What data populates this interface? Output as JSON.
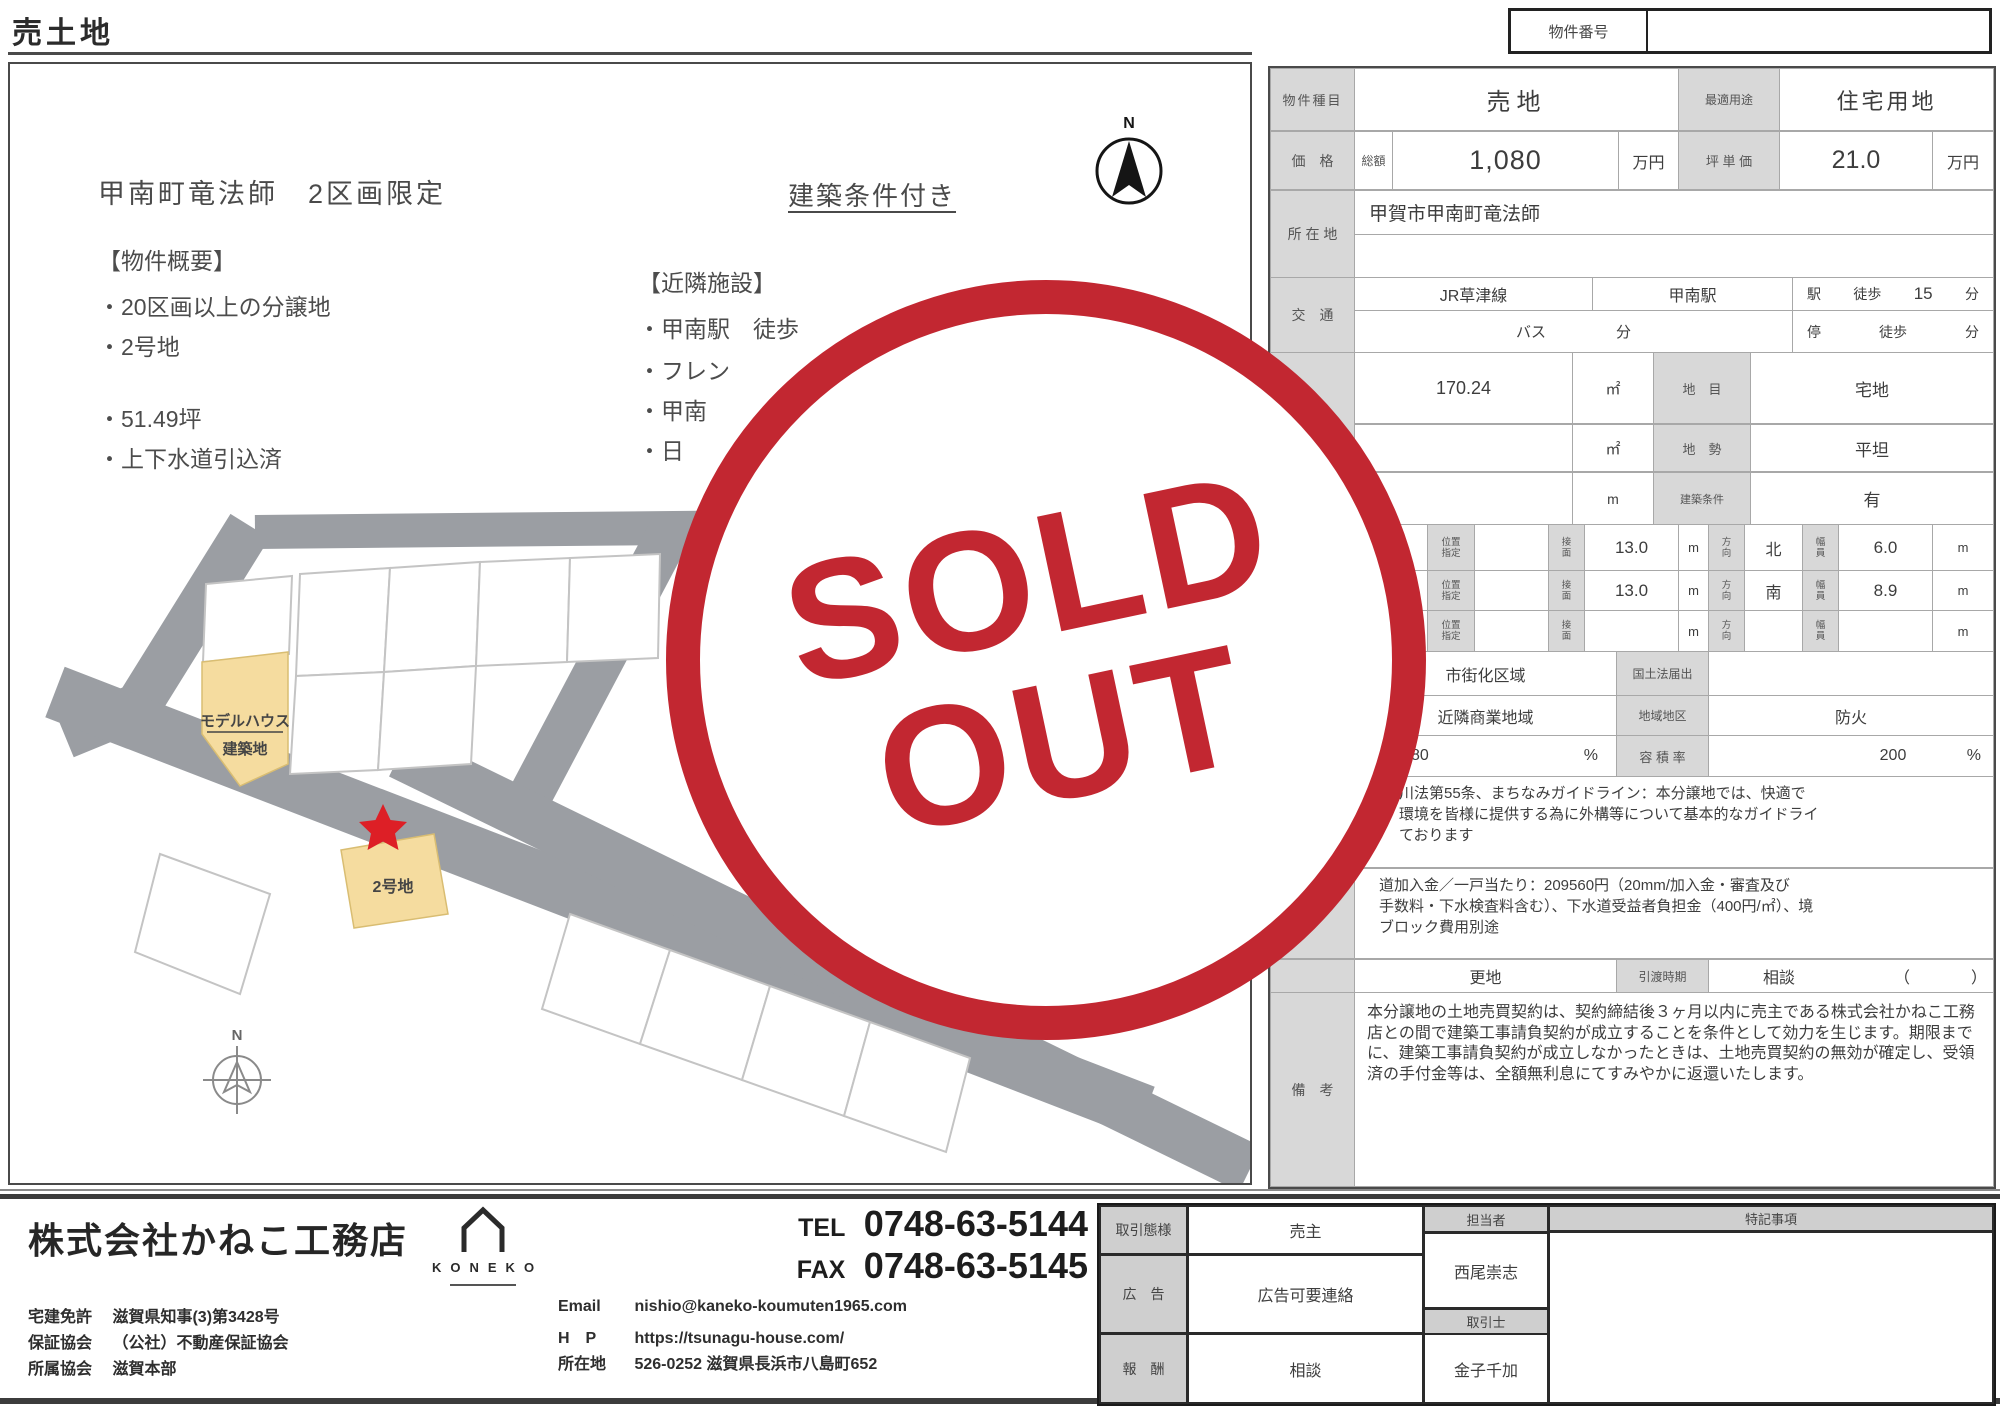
{
  "page_title": "売土地",
  "property_number": {
    "label": "物件番号",
    "value": ""
  },
  "left": {
    "heading": "甲南町竜法師　2区画限定",
    "condition_note": "建築条件付き",
    "overview_title": "【物件概要】",
    "overview": [
      "・20区画以上の分譲地",
      "・2号地",
      "・51.49坪",
      "・上下水道引込済"
    ],
    "nearby_title": "【近隣施設】",
    "nearby": [
      "・甲南駅　徒歩",
      "・フレン",
      "・甲南",
      "・日"
    ],
    "map": {
      "lot1_line1": "モデルハウス",
      "lot1_line2": "建築地",
      "lot2": "2号地",
      "compass": "N"
    },
    "compass_n": "N"
  },
  "t": {
    "r1": {
      "label": "物件種目",
      "value": "売地",
      "use_label": "最適用途",
      "use_value": "住宅用地"
    },
    "r2": {
      "label": "価　格",
      "total_label": "総額",
      "value": "1,080",
      "unit": "万円",
      "tsubo_label": "坪 単 価",
      "tsubo_value": "21.0",
      "tsubo_unit": "万円"
    },
    "r3": {
      "label": "所 在 地",
      "value": "甲賀市甲南町竜法師"
    },
    "r4": {
      "label": "交　通",
      "line": "JR草津線",
      "station": "甲南駅",
      "sta": "駅",
      "walk": "徒歩",
      "min": "15",
      "min_unit": "分",
      "bus": "バス",
      "bus_min": "分",
      "stop": "停",
      "stop_walk": "徒歩",
      "stop_min": "分"
    },
    "r5": {
      "label1": "地 面 積",
      "label2": "（公簿）",
      "value": "170.24",
      "unit": "㎡",
      "sub_label": "地　目",
      "sub_value": "宅地"
    },
    "r6": {
      "unit": "㎡",
      "sub_label": "地　勢",
      "sub_value": "平坦"
    },
    "r7": {
      "unit": "m",
      "sub_label": "建築条件",
      "sub_value": "有"
    },
    "roads": {
      "label": "接　道",
      "pos1": "位置",
      "pos2": "指定",
      "men1": "接",
      "men2": "面",
      "dir1": "方",
      "dir2": "向",
      "wid1": "幅",
      "wid2": "員",
      "rows": [
        {
          "len": "13.0",
          "m1": "m",
          "dir": "北",
          "wid": "6.0",
          "m2": "m"
        },
        {
          "len": "13.0",
          "m1": "m",
          "dir": "南",
          "wid": "8.9",
          "m2": "m"
        },
        {
          "len": "",
          "m1": "m",
          "dir": "",
          "wid": "",
          "m2": "m"
        }
      ]
    },
    "r11": {
      "value": "市街化区域",
      "sub_label": "国土法届出",
      "sub_value": ""
    },
    "r12": {
      "value": "近隣商業地域",
      "sub_label": "地域地区",
      "sub_value": "防火"
    },
    "r13": {
      "value": "80",
      "pct": "%",
      "sub_label": "容 積 率",
      "sub_value": "200",
      "pct2": "%"
    },
    "notes1": [
      "川法第55条、まちなみガイドライン：本分譲地では、快適で",
      "環境を皆様に提供する為に外構等について基本的なガイドライ",
      "ております"
    ],
    "notes2": [
      "道加入金／一戸当たり：209560円（20mm/加入金・審査及び",
      "手数料・下水検査料含む）、下水道受益者負担金（400円/㎡）、境",
      "ブロック費用別途"
    ],
    "r16": {
      "value": "更地",
      "sub_label": "引渡時期",
      "sub_value": "相談",
      "paren_open": "（",
      "paren_close": "）"
    },
    "r17": {
      "label": "備　考",
      "text": "本分譲地の土地売買契約は、契約締結後３ヶ月以内に売主である株式会社かねこ工務店との間で建築工事請負契約が成立することを条件として効力を生じます。期限までに、建築工事請負契約が成立しなかったときは、土地売買契約の無効が確定し、受領済の手付金等は、全額無利息にてすみやかに返還いたします。"
    }
  },
  "stamp": {
    "line1": "SOLD",
    "line2": "OUT",
    "color": "#c22731"
  },
  "footer": {
    "company": "株式会社かねこ工務店",
    "logo_text": "KONEKO",
    "licenses": [
      {
        "label": "宅建免許",
        "value": "滋賀県知事(3)第3428号"
      },
      {
        "label": "保証協会",
        "value": "（公社）不動産保証協会"
      },
      {
        "label": "所属協会",
        "value": "滋賀本部"
      }
    ],
    "tel_label": "TEL",
    "tel": "0748-63-5144",
    "fax_label": "FAX",
    "fax": "0748-63-5145",
    "contacts": [
      {
        "label": "Email",
        "value": "nishio@kaneko-koumuten1965.com"
      },
      {
        "label": "H　P",
        "value": "https://tsunagu-house.com/"
      },
      {
        "label": "所在地",
        "value": "526-0252 滋賀県長浜市八島町652"
      }
    ],
    "deal": {
      "r1_label": "取引態様",
      "r1_value": "売主",
      "r2_label": "広　告",
      "r2_value": "広告可要連絡",
      "r3_label": "報　酬",
      "r3_value": "相談",
      "mid_h1": "担当者",
      "name1": "西尾崇志",
      "mid_h2": "取引士",
      "name2": "金子千加",
      "right_h": "特記事項"
    }
  }
}
